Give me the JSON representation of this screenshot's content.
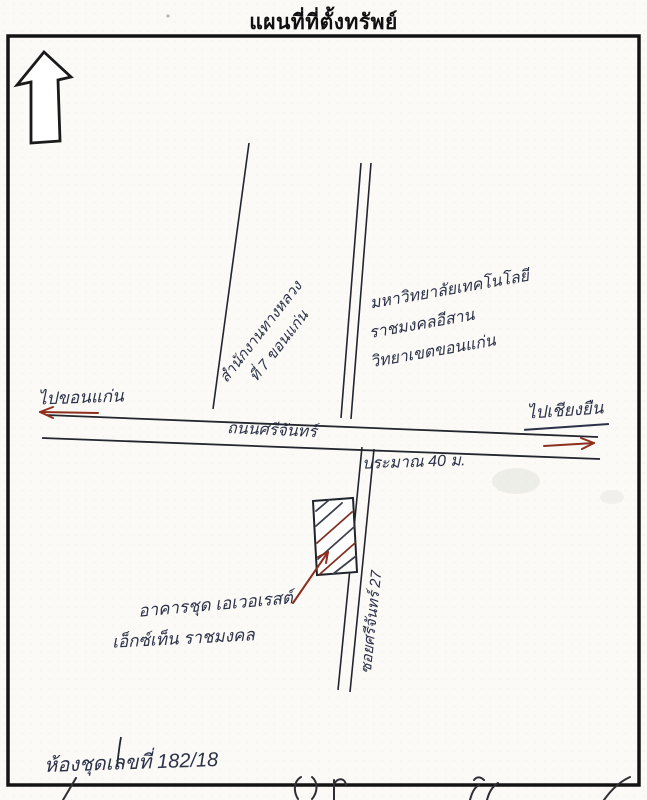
{
  "page": {
    "title": "แผนที่ที่ตั้งทรัพย์"
  },
  "map": {
    "directions": {
      "left": "ไปขอนแก่น",
      "right": "ไปเชียงยืน"
    },
    "roads": {
      "main": "ถนนศรีจันทร์",
      "soi": "ซอยศรีจันทร์ 27"
    },
    "landmarks": {
      "highway_office": {
        "lines": [
          "สำนักงานทางหลวง",
          "ที่ 7 ขอนแก่น"
        ]
      },
      "university": {
        "lines": [
          "มหาวิทยาลัยเทคโนโลยี",
          "ราชมงคลอีสาน",
          "วิทยาเขตขอนแก่น"
        ]
      }
    },
    "distance_note": "ประมาณ 40 ม.",
    "property": {
      "lines": [
        "อาคารชุด เอเวอเรสต์",
        "เอ็กซ์เท็น ราชมงคล"
      ]
    },
    "unit_number": "ห้องชุดเลขที่ 182/18"
  },
  "colors": {
    "ink": "#23262e",
    "handwriting_ink": "#2b3148",
    "red_arrow": "#8e2f1e",
    "paper": "#fbfaf7"
  }
}
